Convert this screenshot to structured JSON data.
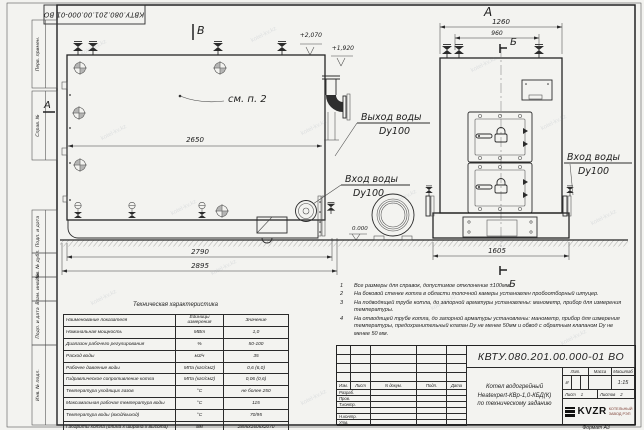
{
  "watermark": {
    "text": "kotel-kv.kz"
  },
  "stamp": {
    "doc_number_rotated": "КВТУ.080.201.00.000-01 ВО"
  },
  "margin": {
    "perv_primen": "Перв. примен.",
    "sprav": "Справ. №",
    "podp_data_1": "Подп. и дата",
    "inv_dubl": "Инв. № дубл.",
    "vzam_inv": "Взам. инв. №",
    "podp_data_2": "Подп. и дата",
    "inv_podl": "Инв. № подл."
  },
  "drawing": {
    "view_a": "А",
    "view_b_top": "Б",
    "view_b": "Б",
    "view_v": "В",
    "view_a_arrow": "А",
    "see_note": "см. п. 2",
    "elev_top": "+2,070",
    "elev_mid": "+1,920",
    "elev_zero": "0.000",
    "dim_2650": "2650",
    "dim_2790": "2790",
    "dim_2895": "2895",
    "dim_1260": "1260",
    "dim_960": "960",
    "dim_1605": "1605",
    "outlet_label": "Выход воды",
    "outlet_dn": "Dy100",
    "inlet_label": "Вход воды",
    "inlet_dn": "Dy100",
    "inlet_label_right": "Вход воды",
    "inlet_dn_right": "Dy100"
  },
  "notes": {
    "items": [
      {
        "num": "1",
        "text": "Все размеры для справок, допустимое отклонение ±100мм."
      },
      {
        "num": "2",
        "text": "На боковой стенке котла в области топочной камеры установлен пробоотборный штуцер."
      },
      {
        "num": "3",
        "text": "На подводящей трубе котла, до запорной арматуры установлены: манометр, прибор для измерения температуры."
      },
      {
        "num": "4",
        "text": "На отводящей трубе котла, до запорной арматуры установлены: манометр, прибор для измерения температуры, предохранительный клапан Dy не менее 50мм и обвод с обратным клапаном Dy не менее 50 мм."
      }
    ]
  },
  "tech_table": {
    "title": "Техническая характеристика",
    "col_name": "Наименование показателя",
    "col_unit": "Единицы измерения",
    "col_value": "Значение",
    "rows": [
      {
        "name": "Номинальная мощность",
        "unit": "МВт",
        "value": "1,0"
      },
      {
        "name": "Диапазон рабочего регулирования",
        "unit": "%",
        "value": "50-100"
      },
      {
        "name": "Расход воды",
        "unit": "м3/ч",
        "value": "35"
      },
      {
        "name": "Рабочее давление воды",
        "unit": "МПа (кгс/см2)",
        "value": "0,6 (6,0)"
      },
      {
        "name": "Гидравлическое сопротивление котла",
        "unit": "МПа (кгс/см2)",
        "value": "0,06 (0,6)"
      },
      {
        "name": "Температура уходящих газов",
        "unit": "°С",
        "value": "не более 250"
      },
      {
        "name": "Максимальная рабочая температура воды",
        "unit": "°С",
        "value": "115"
      },
      {
        "name": "Температура воды (вход/выход)",
        "unit": "°С",
        "value": "70/95"
      },
      {
        "name": "Габариты котла (длина х ширина х высота)",
        "unit": "мм",
        "value": "2895х1605х2070"
      }
    ]
  },
  "title_block": {
    "doc_number": "КВТУ.080.201.00.000-01 ВО",
    "name_line1": "Котел водогрейный",
    "name_line2": "Heatexpert-КВр-1,0-КБД(К)",
    "name_line3": "по техническому заданию",
    "h_izm": "Изм.",
    "h_list": "Лист",
    "h_docum": "N докум.",
    "h_podp": "Подп.",
    "h_data": "Дата",
    "r_razrab": "Разраб.",
    "r_prov": "Пров.",
    "r_tkontr": "Т.контр.",
    "r_nkontr": "Н.контр.",
    "r_utv": "Утв.",
    "h_lit": "Лит.",
    "h_massa": "Масса",
    "h_masshtab": "Масштаб",
    "lit_value": "И",
    "scale_value": "1:15",
    "sheet_label": "Лист",
    "sheet_value": "1",
    "sheets_label": "Листов",
    "sheets_value": "2",
    "logo_text": "KVZR",
    "logo_sub1": "КОТЕЛЬНЫЙ",
    "logo_sub2": "ЗАВОД РЭП",
    "format_label": "Формат",
    "format_value": "А3"
  }
}
